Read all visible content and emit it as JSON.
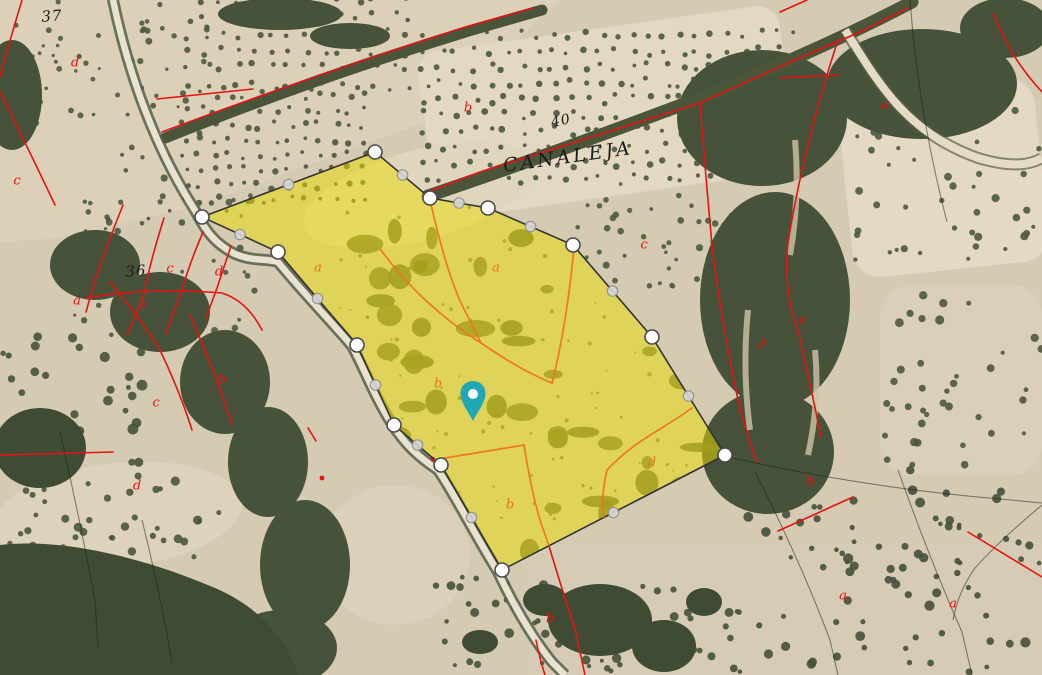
{
  "map": {
    "place_labels": [
      {
        "text": "37",
        "x": 52,
        "y": 17,
        "rotate": -4,
        "size": 15,
        "letter_spacing": 1
      },
      {
        "text": "36",
        "x": 136,
        "y": 272,
        "rotate": -4,
        "size": 15,
        "letter_spacing": 1
      },
      {
        "text": "40",
        "x": 561,
        "y": 121,
        "rotate": -12,
        "size": 14,
        "letter_spacing": 1
      },
      {
        "text": "CANALEJA",
        "x": 568,
        "y": 158,
        "rotate": -8,
        "size": 19,
        "letter_spacing": 3
      }
    ],
    "subparcel_letters": [
      {
        "text": "d",
        "x": 75,
        "y": 63
      },
      {
        "text": "c",
        "x": 17,
        "y": 181
      },
      {
        "text": "c",
        "x": 170,
        "y": 269
      },
      {
        "text": "d",
        "x": 219,
        "y": 272
      },
      {
        "text": "a",
        "x": 77,
        "y": 301
      },
      {
        "text": "b",
        "x": 143,
        "y": 304
      },
      {
        "text": "b",
        "x": 222,
        "y": 380
      },
      {
        "text": "c",
        "x": 156,
        "y": 403
      },
      {
        "text": "d",
        "x": 137,
        "y": 486
      },
      {
        "text": "b",
        "x": 468,
        "y": 108
      },
      {
        "text": "a",
        "x": 885,
        "y": 105
      },
      {
        "text": "c",
        "x": 644,
        "y": 245
      },
      {
        "text": "e",
        "x": 803,
        "y": 320
      },
      {
        "text": "d",
        "x": 762,
        "y": 345
      },
      {
        "text": "b",
        "x": 810,
        "y": 482
      },
      {
        "text": "b",
        "x": 550,
        "y": 619
      },
      {
        "text": "a",
        "x": 843,
        "y": 596
      },
      {
        "text": "a",
        "x": 953,
        "y": 604
      }
    ],
    "interior_letters": [
      {
        "text": "a",
        "x": 318,
        "y": 268
      },
      {
        "text": "a",
        "x": 496,
        "y": 268
      },
      {
        "text": "b",
        "x": 438,
        "y": 384
      },
      {
        "text": "d",
        "x": 652,
        "y": 463
      },
      {
        "text": "b",
        "x": 510,
        "y": 505
      }
    ],
    "selected_parcel": {
      "vertices": [
        [
          202,
          217
        ],
        [
          375,
          152
        ],
        [
          430,
          198
        ],
        [
          488,
          208
        ],
        [
          573,
          245
        ],
        [
          652,
          337
        ],
        [
          725,
          455
        ],
        [
          502,
          570
        ],
        [
          441,
          465
        ],
        [
          394,
          425
        ],
        [
          357,
          345
        ],
        [
          278,
          252
        ]
      ]
    },
    "marker": {
      "x": 473,
      "y": 400
    },
    "colors": {
      "parcel_fill": "#ecdc00",
      "parcel_fill_opacity": "0.5",
      "parcel_outline": "#333333",
      "vertex_fill": "#ffffff",
      "vertex_stroke": "#4a4a4a",
      "midpoint_fill": "#d6d6d6",
      "midpoint_stroke": "#8f8f8f",
      "marker_color": "#20a8b5",
      "cadastral_red": "#e81212",
      "interior_orange": "#ef7418",
      "label_black": "#1c1c1c"
    }
  }
}
